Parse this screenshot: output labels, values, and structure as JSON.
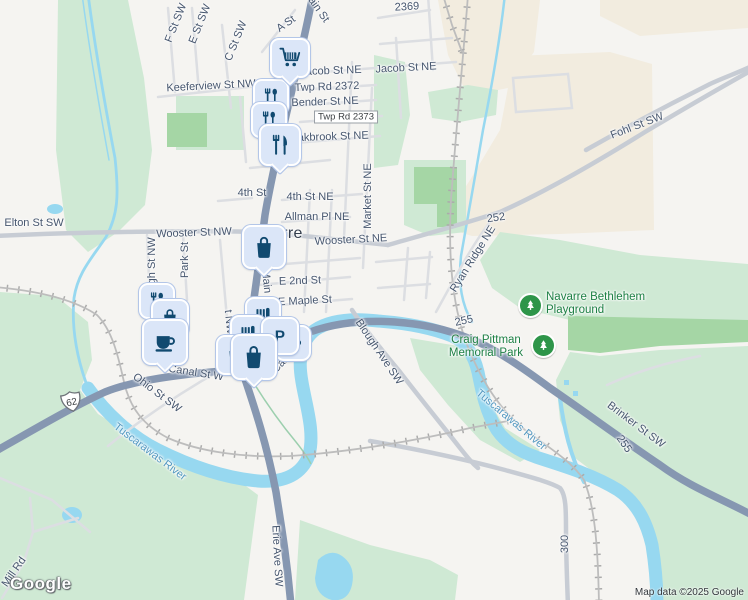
{
  "logo": "Google",
  "attribution": "Map data ©2025 Google",
  "city": {
    "name": "Navarre",
    "x": 273,
    "y": 234
  },
  "shield": {
    "text": "62",
    "x": 72,
    "y": 404
  },
  "boxed_label": {
    "text": "Twp Rd 2373",
    "x": 346,
    "y": 117
  },
  "colors": {
    "street_text": "#46566e",
    "water_text": "#5398c0",
    "park_text": "#1e8045",
    "city_text": "#333d4c",
    "road_highway": "#8697b1",
    "water": "#97d8f0",
    "park": "#cfe9d4",
    "park_dark": "#a5d6a5",
    "beige": "#f2ecdf",
    "pin_glyph": "#114a70"
  },
  "street_labels": [
    {
      "t": "F St SW",
      "x": 176,
      "y": 23,
      "r": -68
    },
    {
      "t": "E St SW",
      "x": 200,
      "y": 24,
      "r": -68
    },
    {
      "t": "C St SW",
      "x": 236,
      "y": 41,
      "r": -68
    },
    {
      "t": "A St",
      "x": 286,
      "y": 24,
      "r": -35
    },
    {
      "t": "Main St",
      "x": 316,
      "y": 6,
      "r": 55
    },
    {
      "t": "2369",
      "x": 407,
      "y": 7,
      "r": -3
    },
    {
      "t": "Jacob St NE",
      "x": 331,
      "y": 71,
      "r": -2
    },
    {
      "t": "Jacob St NE",
      "x": 406,
      "y": 68,
      "r": -3
    },
    {
      "t": "Twp Rd 2372",
      "x": 327,
      "y": 87,
      "r": -2
    },
    {
      "t": "Bender St NE",
      "x": 325,
      "y": 102,
      "r": -2
    },
    {
      "t": "Oakbrook St NE",
      "x": 329,
      "y": 137,
      "r": -2
    },
    {
      "t": "Keeferview St NW",
      "x": 211,
      "y": 86,
      "r": -3
    },
    {
      "t": "Fohl St SW",
      "x": 637,
      "y": 126,
      "r": -21
    },
    {
      "t": "Market St NE",
      "x": 368,
      "y": 196,
      "r": -90
    },
    {
      "t": "4th St",
      "x": 252,
      "y": 193,
      "r": 0
    },
    {
      "t": "4th St NE",
      "x": 310,
      "y": 197,
      "r": 0
    },
    {
      "t": "Allman Pl NE",
      "x": 317,
      "y": 217,
      "r": 0
    },
    {
      "t": "252",
      "x": 496,
      "y": 218,
      "r": -8
    },
    {
      "t": "Elton St SW",
      "x": 34,
      "y": 223,
      "r": 0
    },
    {
      "t": "Wooster St NW",
      "x": 194,
      "y": 233,
      "r": -2
    },
    {
      "t": "Wooster St NE",
      "x": 351,
      "y": 240,
      "r": -3
    },
    {
      "t": "Ryan Ridge NE",
      "x": 473,
      "y": 259,
      "r": -58
    },
    {
      "t": "High St NW",
      "x": 152,
      "y": 266,
      "r": -90
    },
    {
      "t": "Park St",
      "x": 185,
      "y": 260,
      "r": -90
    },
    {
      "t": "Main St",
      "x": 267,
      "y": 288,
      "r": 84
    },
    {
      "t": "E 2nd St",
      "x": 300,
      "y": 281,
      "r": -2
    },
    {
      "t": "E Maple St",
      "x": 305,
      "y": 301,
      "r": -3
    },
    {
      "t": "t NW",
      "x": 229,
      "y": 322,
      "r": 84
    },
    {
      "t": "255",
      "x": 464,
      "y": 321,
      "r": -12
    },
    {
      "t": "Canal St W",
      "x": 196,
      "y": 373,
      "r": 9
    },
    {
      "t": "Canal St E",
      "x": 292,
      "y": 352,
      "r": -47
    },
    {
      "t": "Ohio St SW",
      "x": 157,
      "y": 393,
      "r": 37
    },
    {
      "t": "Blough Ave SW",
      "x": 379,
      "y": 352,
      "r": 56
    },
    {
      "t": "Brinker St SW",
      "x": 636,
      "y": 425,
      "r": 37
    },
    {
      "t": "255",
      "x": 624,
      "y": 444,
      "r": 55
    },
    {
      "t": "Erie Ave SW",
      "x": 277,
      "y": 556,
      "r": 87
    },
    {
      "t": "Mill Rd",
      "x": 14,
      "y": 572,
      "r": -55
    },
    {
      "t": "300",
      "x": 565,
      "y": 544,
      "r": -90
    }
  ],
  "water_labels": [
    {
      "t": "Tuscarawas River",
      "x": 150,
      "y": 452,
      "r": 37
    },
    {
      "t": "Tuscarawas River",
      "x": 511,
      "y": 420,
      "r": 40
    }
  ],
  "park_labels": [
    {
      "lines": [
        "Navarre Bethlehem",
        "Playground"
      ],
      "x": 546,
      "y": 291,
      "align": "left"
    },
    {
      "lines": [
        "Craig Pittman",
        "Memorial Park"
      ],
      "x": 486,
      "y": 334,
      "align": "center"
    }
  ],
  "tree_markers": [
    {
      "x": 530,
      "y": 305
    },
    {
      "x": 543,
      "y": 345
    }
  ],
  "pins": [
    {
      "type": "restaurant",
      "x": 271,
      "y": 97,
      "s": 36
    },
    {
      "type": "restaurant",
      "x": 269,
      "y": 120,
      "s": 36
    },
    {
      "type": "restaurant2",
      "x": 280,
      "y": 145,
      "s": 42,
      "ptr": true
    },
    {
      "type": "grocery",
      "x": 290,
      "y": 58,
      "s": 40,
      "ptr": true
    },
    {
      "type": "shopping",
      "x": 264,
      "y": 247,
      "s": 44,
      "ptr": true
    },
    {
      "type": "restaurant",
      "x": 157,
      "y": 301,
      "s": 36
    },
    {
      "type": "shopping",
      "x": 170,
      "y": 318,
      "s": 38
    },
    {
      "type": "cafe",
      "x": 165,
      "y": 342,
      "s": 46,
      "ptr": true
    },
    {
      "type": "store",
      "x": 263,
      "y": 315,
      "s": 36
    },
    {
      "type": "store",
      "x": 248,
      "y": 333,
      "s": 36
    },
    {
      "type": "cafe",
      "x": 293,
      "y": 343,
      "s": 36
    },
    {
      "type": "parking",
      "x": 280,
      "y": 336,
      "s": 38
    },
    {
      "type": "shopping",
      "x": 236,
      "y": 355,
      "s": 40
    },
    {
      "type": "shopping",
      "x": 254,
      "y": 357,
      "s": 46,
      "ptr": true
    }
  ]
}
